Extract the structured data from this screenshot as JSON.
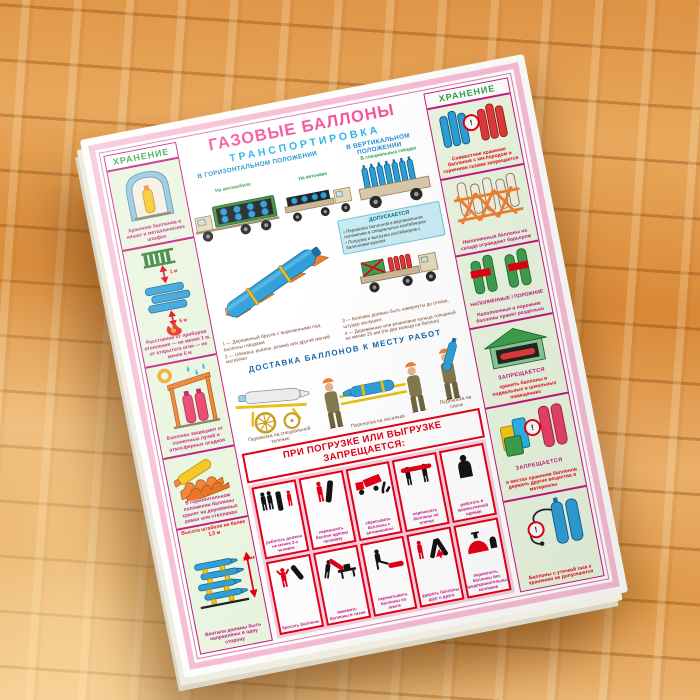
{
  "colors": {
    "frame_pink": "#f6bdd5",
    "accent_magenta": "#c2187e",
    "danger_red": "#e30016",
    "storage_green": "#2e9e44",
    "heading_blue": "#1f8fd0",
    "title_pink": "#f4559c",
    "panel_bg": "#e9f5df"
  },
  "icons": {
    "warning": "!"
  },
  "measurements": {
    "stack_height": "1,5 м",
    "radiator_gap": "1 м",
    "fire_gap": "5 м"
  },
  "poster": {
    "title": "ГАЗОВЫЕ БАЛЛОНЫ",
    "subtitle": "ТРАНСПОРТИРОВКА",
    "left": {
      "header": "ХРАНЕНИЕ",
      "panels": [
        {
          "caption": "Хранение баллонов в нишах и металлических шкафах"
        },
        {
          "caption": "Расстояние от приборов отопления — не менее 1 м, от открытого огня — не менее 5 м"
        },
        {
          "caption": "Баллоны защищают от солнечных лучей и атмосферных осадков"
        },
        {
          "caption": "В горизонтальном положении баллоны хранят на деревянных рамах или стеллажах"
        },
        {
          "note": "Высота штабеля не более 1,5 м",
          "caption": "Вентили должны быть направлены в одну сторону"
        }
      ]
    },
    "right": {
      "header": "ХРАНЕНИЕ",
      "panels": [
        {
          "caption": "Совместное хранение баллонов с кислородом и горючими газами запрещается"
        },
        {
          "caption": "Наполненные баллоны на складе ограждают барьером"
        },
        {
          "tags": [
            "НАПОЛНЕННЫЕ",
            "ПОРОЖНИЕ"
          ],
          "caption": "Наполненные и порожние баллоны хранят раздельно"
        },
        {
          "title": "ЗАПРЕЩАЕТСЯ",
          "caption": "хранить баллоны в подвальных и цокольных помещениях"
        },
        {
          "title": "ЗАПРЕЩАЕТСЯ",
          "caption": "в местах хранения баллонов держать другие вещества и материалы"
        },
        {
          "caption": "Баллоны с утечкой газа к хранению не допускаются"
        }
      ]
    },
    "transport": {
      "horizontal": {
        "heading": "В ГОРИЗОНТАЛЬНОМ ПОЛОЖЕНИИ",
        "labels": [
          "На автомобиле",
          "На автокаре"
        ]
      },
      "vertical": {
        "heading": "В ВЕРТИКАЛЬНОМ ПОЛОЖЕНИИ",
        "label": "В специальных гнёздах"
      },
      "notes": [
        "1 — Деревянный брусок с вырезанными под баллоны гнёздами",
        "2 — Обвязка: войлок, резина или другой мягкий материал",
        "3 — Колпаки должны быть навернуты до отказа, штуцер заглушен",
        "4 — Деревянные или резиновые кольца толщиной не менее 25 мм (по два кольца на баллон)"
      ],
      "allowed": {
        "title": "ДОПУСКАЕТСЯ",
        "items": [
          "Перевозка баллонов в вертикальном положении в специальных контейнерах",
          "Погрузка и выгрузка контейнеров с баллонами краном"
        ]
      }
    },
    "delivery": {
      "heading": "ДОСТАВКА БАЛЛОНОВ К МЕСТУ РАБОТ",
      "captions": [
        "Перевозка на специальной тележке",
        "Переноска на носилках",
        "Переноска на плече"
      ]
    },
    "prohibition": {
      "banner": "ПРИ ПОГРУЗКЕ ИЛИ ВЫГРУЗКЕ ЗАПРЕЩАЕТСЯ:",
      "cells": [
        {
          "caption": "работать должно не менее 2-х человек"
        },
        {
          "caption": "переносить баллон одному человеку"
        },
        {
          "caption": "сбрасывать баллоны с автомашины"
        },
        {
          "caption": "переносить баллоны на плечах"
        },
        {
          "caption": "работать в промасленной одежде"
        },
        {
          "caption": "бросать баллоны"
        },
        {
          "caption": "зажимать баллоны в тиски"
        },
        {
          "caption": "перекатывать баллоны по земле"
        },
        {
          "caption": "ударять баллоны друг о друга"
        },
        {
          "caption": "перевозить баллоны без предохранительных колпаков"
        }
      ]
    }
  }
}
